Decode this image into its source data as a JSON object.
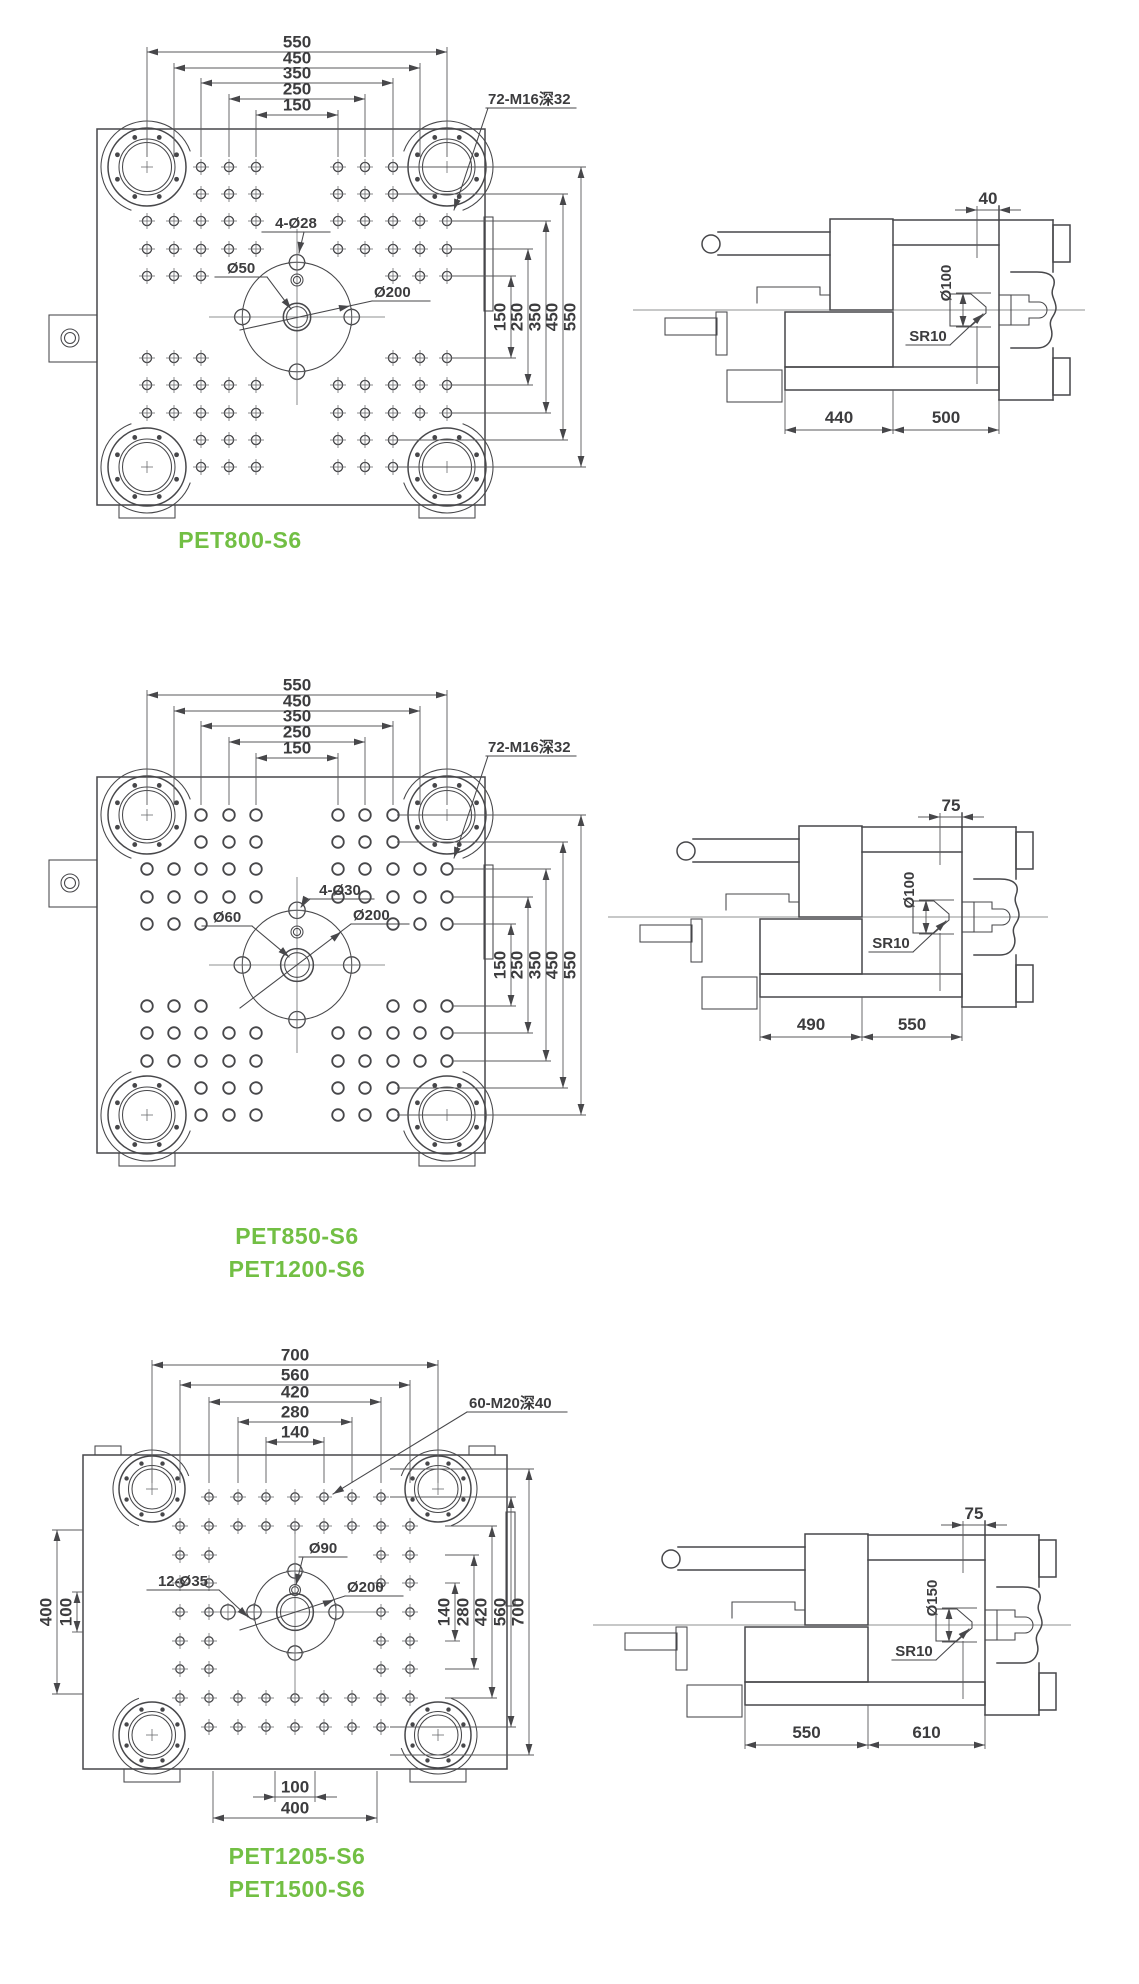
{
  "colors": {
    "line": "#47474a",
    "dimension": "#58585b",
    "text": "#3c3c3e",
    "model_green": "#72bf44",
    "background": "#ffffff"
  },
  "sections": [
    {
      "models": [
        "PET800-S6"
      ],
      "front_view": {
        "top_dims": [
          "550",
          "450",
          "350",
          "250",
          "150"
        ],
        "right_dims": [
          "150",
          "250",
          "350",
          "450",
          "550"
        ],
        "thread_label": "72-M16深32",
        "bolt_holes_label": "4-Ø28",
        "center_hole_label": "Ø50",
        "bolt_circle_label": "Ø200"
      },
      "side_view": {
        "offset_dim": "40",
        "ring_dim": "Ø100",
        "sprue_radius_label": "SR10",
        "bottom_dims": [
          "440",
          "500"
        ]
      }
    },
    {
      "models": [
        "PET850-S6",
        "PET1200-S6"
      ],
      "front_view": {
        "top_dims": [
          "550",
          "450",
          "350",
          "250",
          "150"
        ],
        "right_dims": [
          "150",
          "250",
          "350",
          "450",
          "550"
        ],
        "thread_label": "72-M16深32",
        "bolt_holes_label": "4-Ø30",
        "center_hole_label": "Ø60",
        "bolt_circle_label": "Ø200"
      },
      "side_view": {
        "offset_dim": "75",
        "ring_dim": "Ø100",
        "sprue_radius_label": "SR10",
        "bottom_dims": [
          "490",
          "550"
        ]
      }
    },
    {
      "models": [
        "PET1205-S6",
        "PET1500-S6"
      ],
      "front_view": {
        "top_dims": [
          "700",
          "560",
          "420",
          "280",
          "140"
        ],
        "right_dims": [
          "140",
          "280",
          "420",
          "560",
          "700"
        ],
        "left_dims": [
          "400",
          "100"
        ],
        "bottom_dims": [
          "100",
          "400"
        ],
        "thread_label": "60-M20深40",
        "bolt_holes_label": "12-Ø35",
        "center_hole_label": "Ø90",
        "bolt_circle_label": "Ø200"
      },
      "side_view": {
        "offset_dim": "75",
        "ring_dim": "Ø150",
        "sprue_radius_label": "SR10",
        "bottom_dims": [
          "550",
          "610"
        ]
      }
    }
  ]
}
